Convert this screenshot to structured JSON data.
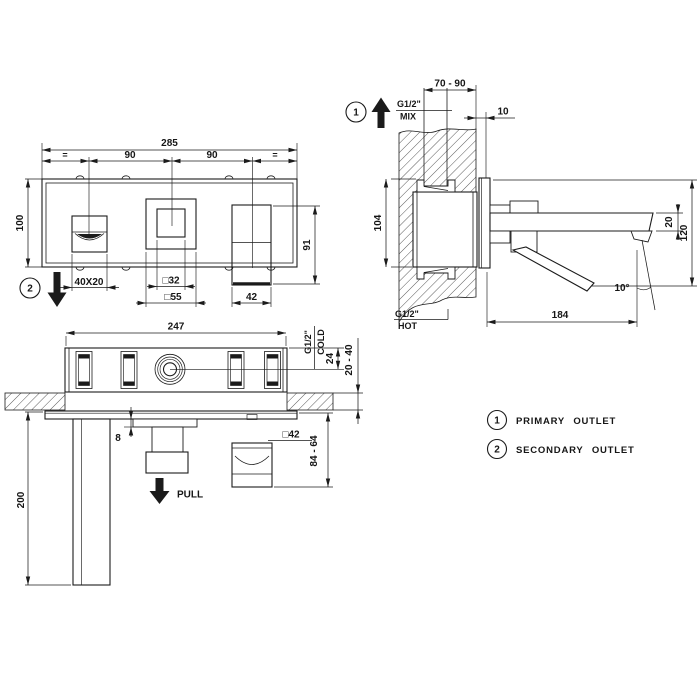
{
  "front_view": {
    "dim_total_width": "285",
    "dim_left_equal": "=",
    "dim_center_left": "90",
    "dim_center_right": "90",
    "dim_right_equal": "=",
    "dim_height": "100",
    "outlet_marker": "2",
    "dim_spout_outlet": "40X20",
    "dim_diverter_inner": "□32",
    "dim_diverter_plate": "□55",
    "dim_handle_height": "91",
    "dim_handle_width": "42"
  },
  "side_view": {
    "outlet_marker": "1",
    "dim_recess_depth": "70 - 90",
    "mix_thread": "G1/2\"",
    "mix_label": "MIX",
    "dim_plate_clearance": "10",
    "dim_body_height": "104",
    "dim_spout_thickness": "20",
    "dim_overall_height": "120",
    "spout_angle": "10°",
    "dim_spout_reach": "184",
    "hot_thread": "G1/2\"",
    "hot_label": "HOT"
  },
  "plan_view": {
    "dim_body_width": "247",
    "cold_thread": "G1/2\"",
    "cold_label": "COLD",
    "dim_cold_offset": "24",
    "dim_wall_thickness": "20 - 40",
    "dim_trim_thickness": "8",
    "dim_handle_square": "□42",
    "dim_handle_projection": "84 - 64",
    "dim_spout_projection": "200",
    "pull_label": "PULL"
  },
  "legend": {
    "item1": {
      "num": "1",
      "label": "PRIMARY OUTLET"
    },
    "item2": {
      "num": "2",
      "label": "SECONDARY OUTLET"
    }
  },
  "colors": {
    "line": "#1b1b1b",
    "background": "#ffffff"
  }
}
